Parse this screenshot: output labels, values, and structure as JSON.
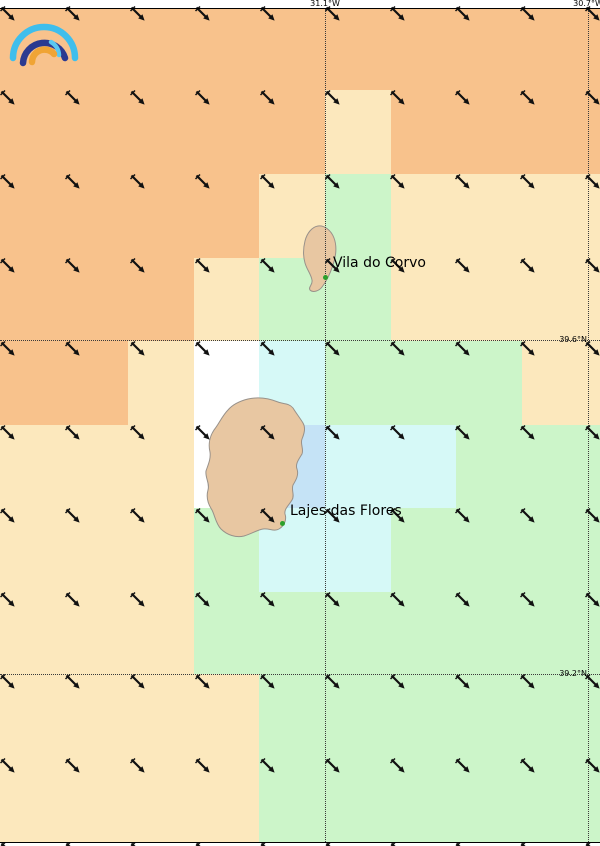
{
  "map": {
    "width": 600,
    "height": 846,
    "background": "#ffffff",
    "frame": {
      "top_y": 8,
      "bottom_y": 842,
      "line_color": "#000000"
    }
  },
  "palette": {
    "O": "#f8c28c",
    "C": "#fce8bd",
    "G": "#ccf5c9",
    "W": "#ffffff",
    "Y": "#d6f9f7",
    "B": "#c5e3f6"
  },
  "grid_cells": {
    "col_edges": [
      0,
      62,
      128,
      194,
      259,
      325,
      391,
      456,
      522,
      588,
      600
    ],
    "row_edges": [
      8,
      90,
      174,
      258,
      341,
      425,
      508,
      592,
      674,
      758,
      842
    ],
    "rows": [
      "OOOOOOOOOO",
      "OOOOOCOOOO",
      "OOOOCGCCCC",
      "OOOCGGCCCC",
      "OOCWYGGGCC",
      "CCCWBYYGGG",
      "CCCGYYGGGG",
      "CCCGGGGGGG",
      "CCCCGGGGGG",
      "CCCCGGGGGG"
    ]
  },
  "meridians": [
    {
      "label": "31.1°W",
      "x": 325
    },
    {
      "label": "30.7°W",
      "x": 588
    }
  ],
  "parallels": [
    {
      "label": "39.6°N",
      "y": 340
    },
    {
      "label": "39.2°N",
      "y": 674
    }
  ],
  "wind": {
    "xs": [
      0,
      65,
      130,
      195,
      260,
      325,
      390,
      455,
      520,
      585
    ],
    "ys": [
      6,
      90,
      174,
      258,
      341,
      425,
      508,
      592,
      674,
      758,
      842
    ],
    "direction": "southeast",
    "direction_deg": 135,
    "color": "#111111"
  },
  "cities": [
    {
      "name": "Vila do Corvo",
      "dot_x": 325,
      "dot_y": 277,
      "label_x": 333,
      "label_y": 255
    },
    {
      "name": "Lajes das Flores",
      "dot_x": 282,
      "dot_y": 523,
      "label_x": 290,
      "label_y": 503
    }
  ],
  "islands": {
    "fill": "#e8c7a2",
    "stroke": "#98918a",
    "dot_color": "#2ca02c"
  },
  "logo": {
    "outer_color": "#3fbeec",
    "middle_color": "#2b3a90",
    "inner_color": "#f0a435",
    "accent_color": "#5ac8f0"
  },
  "line_colors": {
    "graticule": "#3a3a3a",
    "text": "#000000"
  }
}
